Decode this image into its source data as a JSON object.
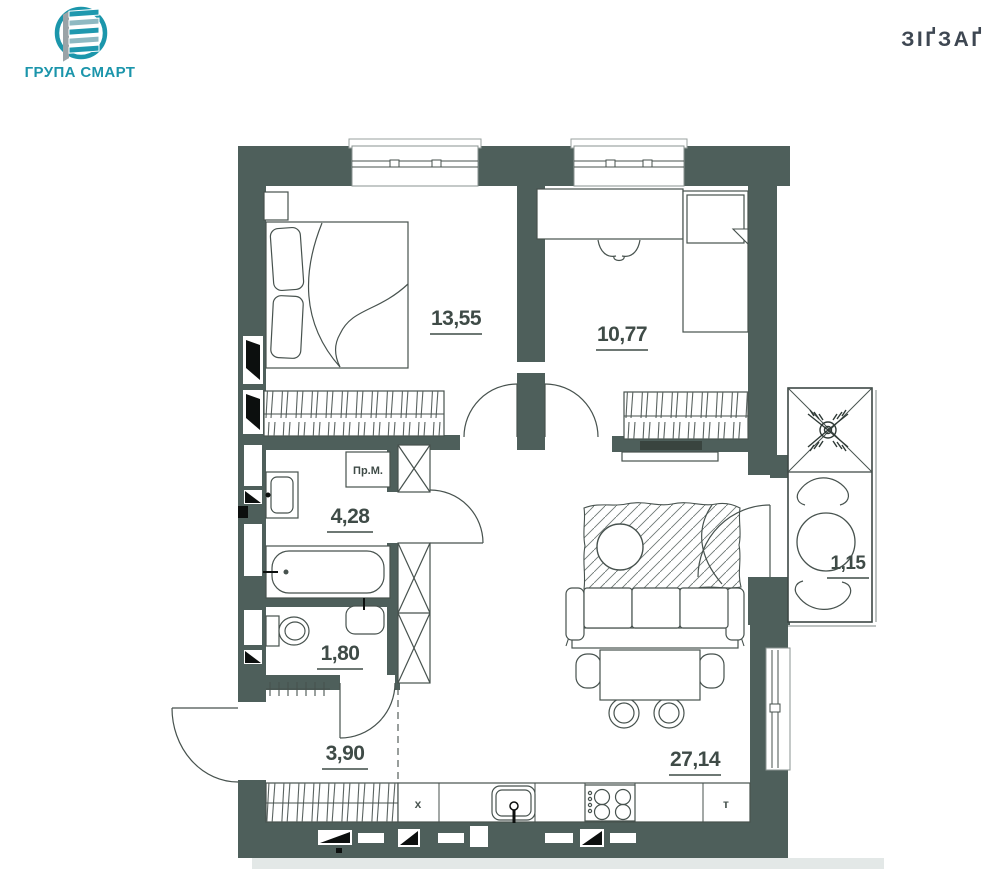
{
  "header": {
    "logo_text": "ГРУПА СМАРТ",
    "brand": "ЗІҐЗАҐ"
  },
  "plan": {
    "rooms": [
      {
        "name": "bedroom-1",
        "area": "13,55"
      },
      {
        "name": "bedroom-2",
        "area": "10,77"
      },
      {
        "name": "bathroom",
        "area": "4,28"
      },
      {
        "name": "wc",
        "area": "1,80"
      },
      {
        "name": "hallway",
        "area": "3,90"
      },
      {
        "name": "kitchen-living",
        "area": "27,14"
      },
      {
        "name": "balcony",
        "area": "1,15"
      }
    ],
    "appliances": {
      "washing_machine": "Пр.М.",
      "fridge": "x",
      "boiler": "т"
    }
  },
  "colors": {
    "wall": "#4e5f5b",
    "line": "#47524e",
    "accent_teal": "#1b96ab",
    "brand_text": "#3e4752"
  }
}
